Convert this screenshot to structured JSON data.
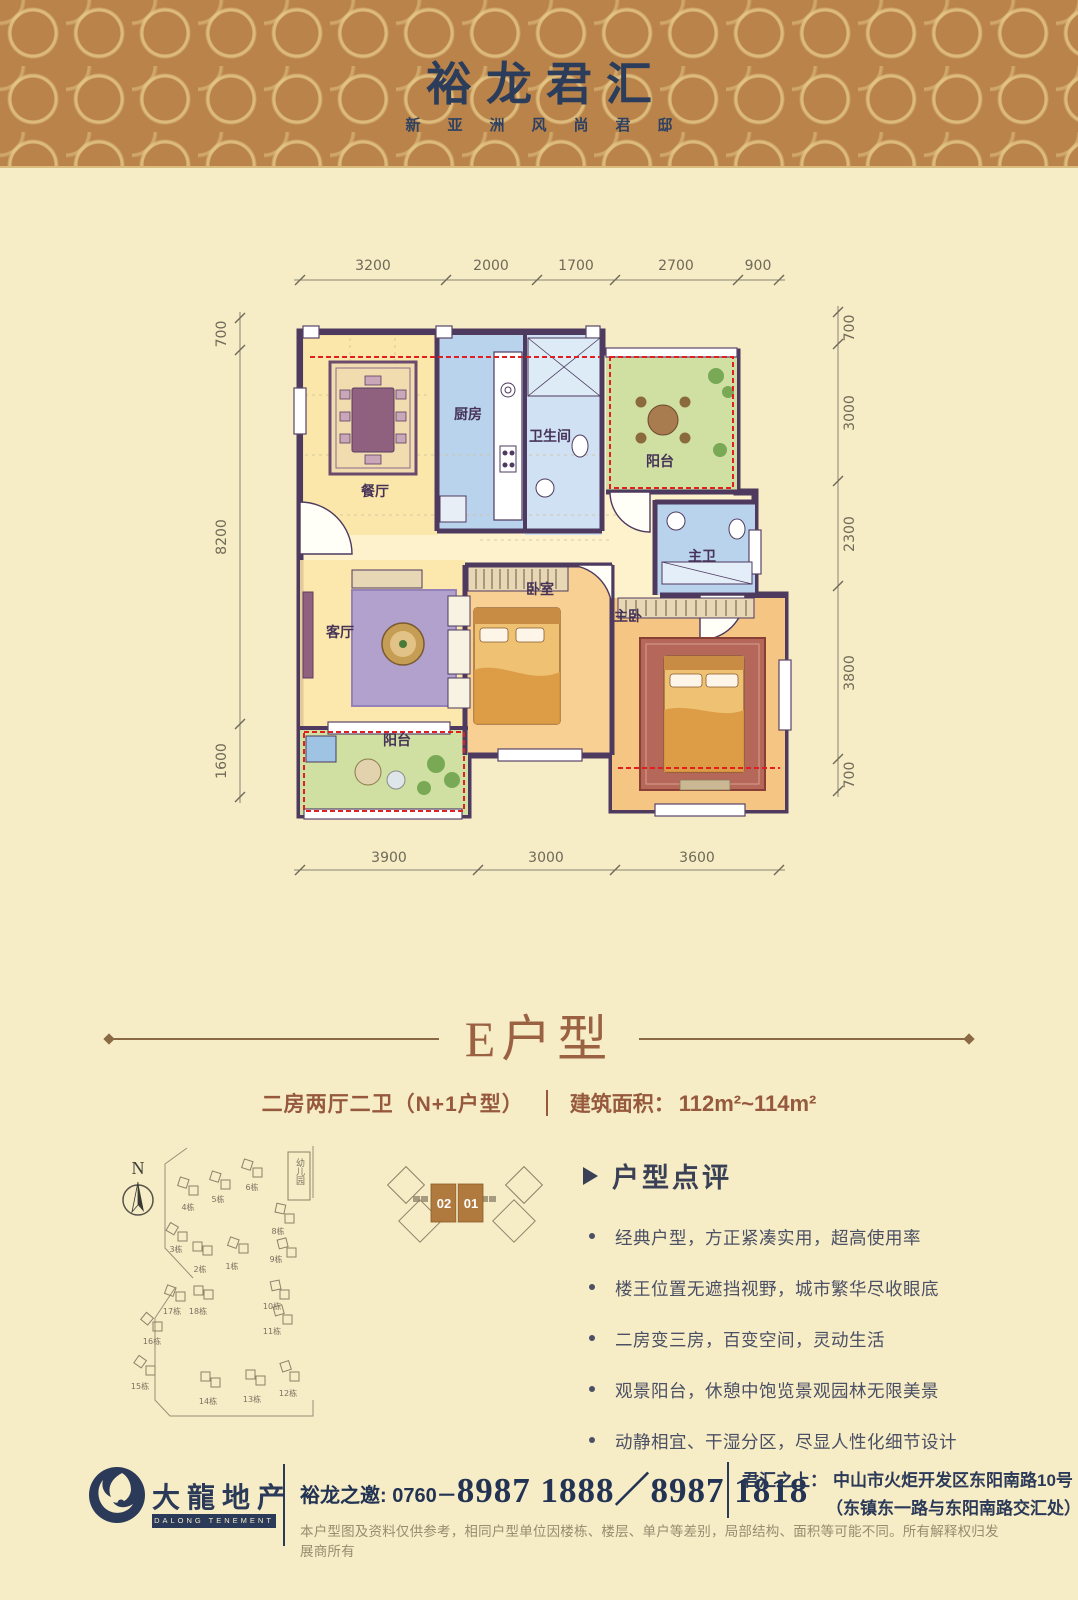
{
  "colors": {
    "header_brown": "#b9834a",
    "pattern_gold": "#e2c482",
    "navy": "#2b3a58",
    "title_brown": "#9a6242",
    "subtitle_brown": "#96593d",
    "wall_purple": "#4e3a5f",
    "dashed_red": "#e02020",
    "highlight_block_brown": "#b07a3e",
    "page_cream": "#f6ecc6"
  },
  "header": {
    "title": "裕龙君汇",
    "tagline": "新亚洲风尚君邸"
  },
  "plan": {
    "rooms": {
      "dining": "餐厅",
      "kitchen": "厨房",
      "bath": "卫生间",
      "balcony_top": "阳台",
      "master_bath": "主卫",
      "living": "客厅",
      "bedroom": "卧室",
      "master_bedroom": "主卧",
      "balcony_bottom": "阳台"
    },
    "dims_top": [
      "3200",
      "2000",
      "1700",
      "2700",
      "900"
    ],
    "dims_bottom": [
      "3900",
      "3000",
      "3600"
    ],
    "dims_left": [
      "700",
      "8200",
      "1600"
    ],
    "dims_right": [
      "700",
      "3000",
      "2300",
      "3800",
      "700"
    ]
  },
  "unit": {
    "name": "E户型",
    "layout": "二房两厅二卫（N+1户型）",
    "area_label": "建筑面积：",
    "area_value": "112m²~114m²"
  },
  "siteplan": {
    "north": "N",
    "kindergarten": "幼儿园",
    "block_02": "02",
    "block_01": "01",
    "buildings": [
      "4栋",
      "5栋",
      "6栋",
      "3栋",
      "2栋",
      "1栋",
      "8栋",
      "9栋",
      "17栋",
      "18栋",
      "16栋",
      "10栋",
      "11栋",
      "15栋",
      "14栋",
      "13栋",
      "12栋"
    ]
  },
  "comments": {
    "title": "户型点评",
    "items": [
      "经典户型，方正紧凑实用，超高使用率",
      "楼王位置无遮挡视野，城市繁华尽收眼底",
      "二房变三房，百变空间，灵动生活",
      "观景阳台，休憩中饱览景观园林无限美景",
      "动静相宜、干湿分区，尽显人性化细节设计"
    ]
  },
  "footer": {
    "logo_cn": "大龍地产",
    "logo_en": "DALONG TENEMENT",
    "phone_label": "裕龙之邀: 0760－",
    "phone_numbers": "8987 1888／8987 1818",
    "address_label": "君汇之上：",
    "address_line1": "中山市火炬开发区东阳南路10号",
    "address_line2": "（东镇东一路与东阳南路交汇处）",
    "disclaimer": "本户型图及资料仅供参考，相同户型单位因楼栋、楼层、单户等差别，局部结构、面积等可能不同。所有解释权归发展商所有"
  }
}
